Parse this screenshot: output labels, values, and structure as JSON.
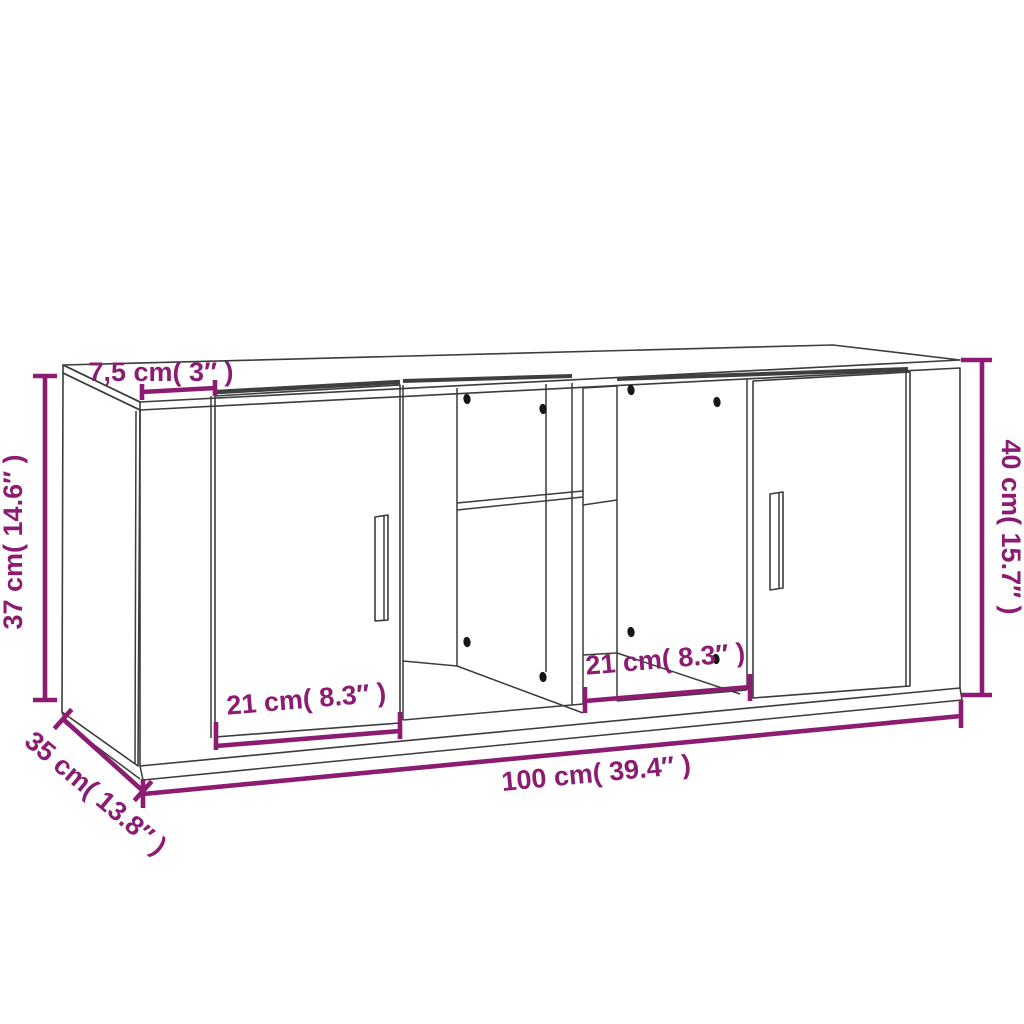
{
  "diagram": {
    "title_semantic": "cabinet-dimension-diagram",
    "background_color": "#ffffff",
    "line_color": "#3c3c3c",
    "accent_color": "#8B1C72",
    "dot_color": "#161616",
    "shadow_color": "#3f3f3f",
    "font_size": 27,
    "labels": [
      {
        "name": "dim-label-top-depth",
        "text": "7,5 cm( 3″ )",
        "x": 161,
        "y": 381,
        "rotate": 0
      },
      {
        "name": "dim-label-side-height",
        "text": "37 cm( 14.6″ )",
        "x": 22,
        "y": 542,
        "rotate": -90
      },
      {
        "name": "dim-label-total-height",
        "text": "40 cm( 15.7″ )",
        "x": 1002,
        "y": 527,
        "rotate": 90
      },
      {
        "name": "dim-label-left-door-width",
        "text": "21 cm( 8.3″ )",
        "x": 307,
        "y": 708,
        "rotate": -4.8
      },
      {
        "name": "dim-label-right-door-width",
        "text": "21 cm( 8.3″ )",
        "x": 666,
        "y": 668,
        "rotate": -4.8
      },
      {
        "name": "dim-label-total-width",
        "text": "100 cm( 39.4″ )",
        "x": 597,
        "y": 782,
        "rotate": -5.4
      },
      {
        "name": "dim-label-depth",
        "text": "35 cm( 13.8″ )",
        "x": 90,
        "y": 800,
        "rotate": 40
      }
    ],
    "dimension_lines": [
      {
        "name": "dim-line-top-depth",
        "segments": [
          [
            142,
            392,
            215,
            388
          ],
          [
            142,
            384,
            142,
            400
          ],
          [
            215,
            380,
            215,
            396
          ]
        ]
      },
      {
        "name": "dim-line-side-height",
        "segments": [
          [
            45,
            376,
            45,
            700
          ],
          [
            33,
            376,
            57,
            376
          ],
          [
            33,
            700,
            57,
            700
          ]
        ]
      },
      {
        "name": "dim-line-total-height",
        "segments": [
          [
            982,
            360,
            982,
            695
          ],
          [
            961,
            360,
            992,
            360
          ],
          [
            961,
            695,
            992,
            695
          ]
        ]
      },
      {
        "name": "dim-line-left-door-width",
        "segments": [
          [
            216,
            746,
            400,
            731
          ],
          [
            216,
            722,
            216,
            750
          ],
          [
            400,
            712,
            400,
            739
          ]
        ]
      },
      {
        "name": "dim-line-right-door-width",
        "segments": [
          [
            585,
            701,
            750,
            687
          ],
          [
            585,
            687,
            585,
            713
          ],
          [
            750,
            674,
            750,
            701
          ]
        ]
      },
      {
        "name": "dim-line-total-width",
        "segments": [
          [
            143,
            794,
            961,
            716
          ],
          [
            143,
            779,
            143,
            808
          ],
          [
            961,
            700,
            961,
            728
          ]
        ]
      },
      {
        "name": "dim-line-depth",
        "segments": [
          [
            63,
            719,
            143,
            791
          ],
          [
            71.7,
            709.3,
            54.3,
            728.7
          ],
          [
            151.7,
            781.3,
            134.3,
            800.7
          ]
        ]
      }
    ],
    "cabinet": {
      "polygons": [
        {
          "name": "top-face",
          "pts": [
            [
              63,
              365
            ],
            [
              833,
              345
            ],
            [
              960,
              360
            ],
            [
              140,
              402
            ]
          ]
        },
        {
          "name": "top-slab-left-face",
          "pts": [
            [
              63,
              365
            ],
            [
              140,
              402
            ],
            [
              140,
              410
            ],
            [
              63,
              373
            ]
          ]
        },
        {
          "name": "front-face",
          "pts": [
            [
              140,
              410
            ],
            [
              960,
              368
            ],
            [
              960,
              688
            ],
            [
              140,
              766
            ]
          ]
        },
        {
          "name": "left-side-face",
          "pts": [
            [
              63,
              373
            ],
            [
              140,
              410
            ],
            [
              138,
              766
            ],
            [
              62,
              712
            ]
          ]
        },
        {
          "name": "left-door",
          "pts": [
            [
              215,
              396
            ],
            [
              400,
              385
            ],
            [
              400,
              723
            ],
            [
              215,
              737
            ]
          ]
        },
        {
          "name": "right-door",
          "pts": [
            [
              753,
              381
            ],
            [
              910,
              372
            ],
            [
              910,
              686
            ],
            [
              753,
              698
            ]
          ]
        },
        {
          "name": "left-door-handle",
          "pts": [
            [
              375,
              517
            ],
            [
              388,
              515
            ],
            [
              388,
              620
            ],
            [
              375,
              621
            ]
          ]
        },
        {
          "name": "right-door-handle",
          "pts": [
            [
              770,
              494
            ],
            [
              783,
              492
            ],
            [
              783,
              588
            ],
            [
              770,
              590
            ]
          ]
        }
      ],
      "lines": [
        {
          "name": "side-front-edge-inner",
          "pts": [
            [
              136,
              411
            ],
            [
              135,
              764
            ]
          ]
        },
        {
          "name": "plinth-front-bottom-edge",
          "pts": [
            [
              143,
              780
            ],
            [
              962,
              700
            ]
          ]
        },
        {
          "name": "plinth-left-join",
          "pts": [
            [
              140,
              766
            ],
            [
              143,
              780
            ]
          ]
        },
        {
          "name": "plinth-right-join",
          "pts": [
            [
              960,
              688
            ],
            [
              962,
              700
            ]
          ]
        },
        {
          "name": "plinth-side-bottom-edge",
          "pts": [
            [
              66,
              724
            ],
            [
              140,
              779
            ]
          ]
        },
        {
          "name": "plinth-side-back-join",
          "pts": [
            [
              62,
              712
            ],
            [
              66,
              724
            ]
          ]
        },
        {
          "name": "left-door-gap-line",
          "pts": [
            [
              211,
              396
            ],
            [
              211,
              738
            ]
          ]
        },
        {
          "name": "opening1-left-edge",
          "pts": [
            [
              403,
              385
            ],
            [
              403,
              720
            ]
          ]
        },
        {
          "name": "opening1-divider-edge",
          "pts": [
            [
              457,
              388
            ],
            [
              457,
              666
            ]
          ]
        },
        {
          "name": "opening1-back-right-edge",
          "pts": [
            [
              546,
              384
            ],
            [
              546,
              672
            ]
          ]
        },
        {
          "name": "partition-front-left-edge",
          "pts": [
            [
              572,
              383
            ],
            [
              572,
              705
            ]
          ]
        },
        {
          "name": "partition-front-right-edge",
          "pts": [
            [
              583,
              388
            ],
            [
              583,
              704
            ]
          ]
        },
        {
          "name": "partition-back-edge",
          "pts": [
            [
              617,
              386
            ],
            [
              617,
              701
            ]
          ]
        },
        {
          "name": "partition-top-edge",
          "pts": [
            [
              583,
              388
            ],
            [
              617,
              386
            ]
          ]
        },
        {
          "name": "partition-bottom-edge",
          "pts": [
            [
              583,
              655
            ],
            [
              617,
              653
            ]
          ]
        },
        {
          "name": "shelf-front-top-edge",
          "pts": [
            [
              457,
              503
            ],
            [
              583,
              491
            ]
          ]
        },
        {
          "name": "shelf-front-bottom-edge",
          "pts": [
            [
              457,
              510
            ],
            [
              583,
              497
            ]
          ]
        },
        {
          "name": "shelf-side-edge",
          "pts": [
            [
              583,
              505
            ],
            [
              617,
              500
            ]
          ]
        },
        {
          "name": "opening1-floor-back-edge",
          "pts": [
            [
              403,
              661
            ],
            [
              457,
              666
            ]
          ]
        },
        {
          "name": "opening1-floor-diagonal",
          "pts": [
            [
              457,
              666
            ],
            [
              583,
              713
            ]
          ]
        },
        {
          "name": "opening2-floor-diagonal",
          "pts": [
            [
              617,
              653
            ],
            [
              740,
              694
            ]
          ]
        },
        {
          "name": "opening1-bottom-edge",
          "pts": [
            [
              403,
              720
            ],
            [
              583,
              704
            ]
          ]
        },
        {
          "name": "opening2-bottom-edge",
          "pts": [
            [
              617,
              701
            ],
            [
              747,
              690
            ]
          ]
        },
        {
          "name": "right-door-gap-line",
          "pts": [
            [
              747,
              379
            ],
            [
              747,
              690
            ]
          ]
        },
        {
          "name": "right-door-inner-edge",
          "pts": [
            [
              906,
              373
            ],
            [
              906,
              687
            ]
          ]
        },
        {
          "name": "left-door-handle-inner",
          "pts": [
            [
              384,
              516
            ],
            [
              384,
              620
            ]
          ]
        },
        {
          "name": "right-door-handle-inner",
          "pts": [
            [
              779,
              493
            ],
            [
              779,
              589
            ]
          ]
        }
      ],
      "shadow_bands": [
        {
          "name": "top-gap-shadow-left",
          "pts": [
            [
              217,
              392
            ],
            [
              400,
              382
            ]
          ],
          "w": 4.5
        },
        {
          "name": "top-gap-shadow-middle",
          "pts": [
            [
              403,
              381
            ],
            [
              572,
              376
            ]
          ],
          "w": 4
        },
        {
          "name": "top-gap-shadow-right",
          "pts": [
            [
              617,
              379
            ],
            [
              908,
              369
            ]
          ],
          "w": 4
        }
      ],
      "peg_holes": [
        [
          467,
          399
        ],
        [
          543,
          409
        ],
        [
          467,
          642
        ],
        [
          543,
          677
        ],
        [
          631,
          390
        ],
        [
          717,
          402
        ],
        [
          631,
          632
        ],
        [
          716,
          659
        ]
      ]
    }
  }
}
